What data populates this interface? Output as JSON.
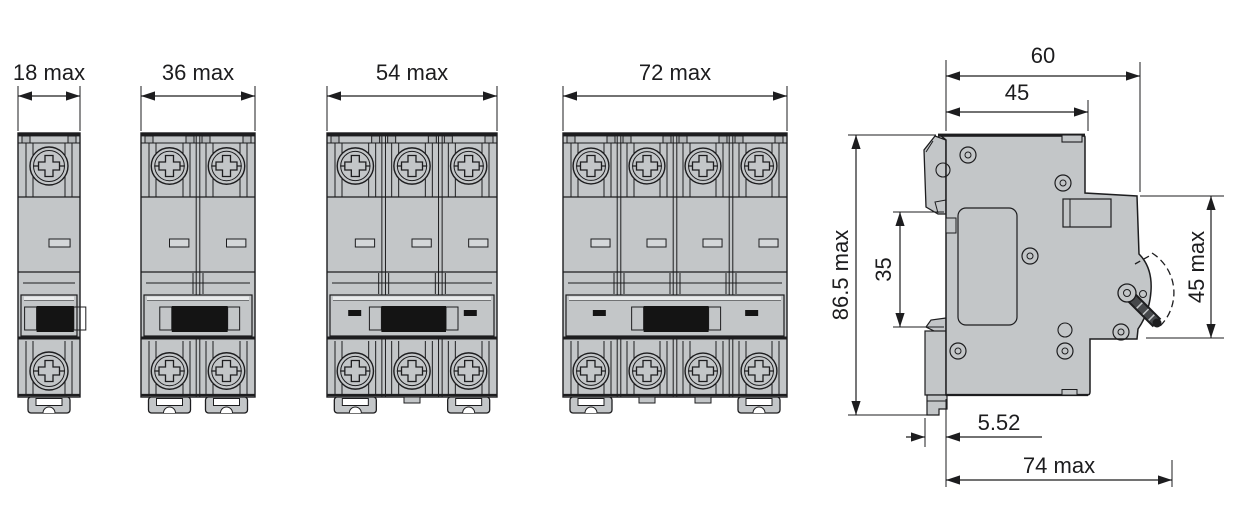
{
  "diagram": {
    "title_semantic": "mcb-dimension-drawing",
    "front_views": [
      {
        "name": "front-view-1-pole",
        "poles": 1,
        "dim_label": "18 max"
      },
      {
        "name": "front-view-2-pole",
        "poles": 2,
        "dim_label": "36 max"
      },
      {
        "name": "front-view-3-pole",
        "poles": 3,
        "dim_label": "54 max"
      },
      {
        "name": "front-view-4-pole",
        "poles": 4,
        "dim_label": "72 max"
      }
    ],
    "side_view": {
      "name": "side-view",
      "dim_labels": {
        "total_depth": "60",
        "body_depth": "45",
        "total_height": "86.5 max",
        "din_rail_recess": "35",
        "front_section_height": "45 max",
        "clip_offset": "5.52",
        "max_depth": "74 max"
      }
    },
    "colors": {
      "body_fill": "#c3c6c8",
      "body_dark": "#b3b6b8",
      "notch_fill": "#d4d7d9",
      "highlight": "#e9ebec",
      "line": "#1d1d1f",
      "toggle_black": "#141414",
      "lever_fill": "#46484b",
      "white": "#ffffff"
    }
  }
}
